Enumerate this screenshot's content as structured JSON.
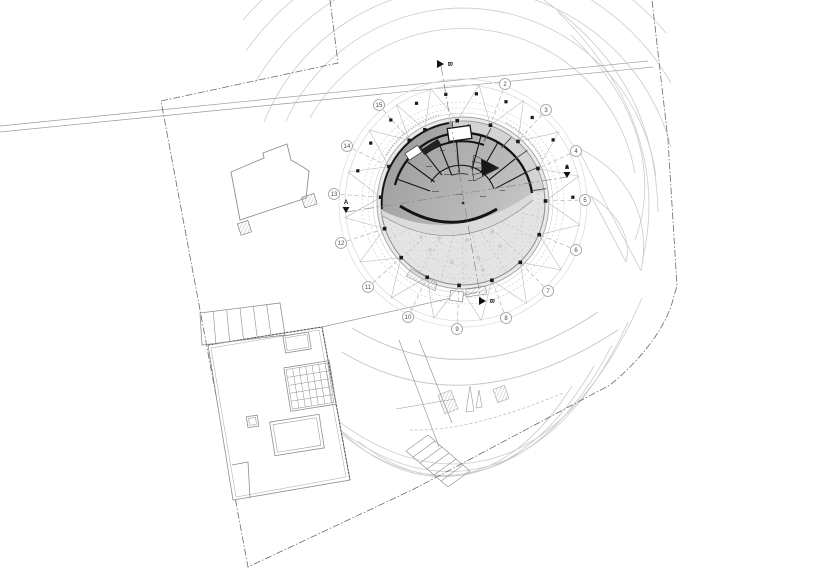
{
  "canvas": {
    "width": 818,
    "height": 578,
    "background": "#ffffff"
  },
  "palette": {
    "landscape": "#cbcbcb",
    "site_line": "#8f8f8f",
    "boundary": "#6a6a6a",
    "grid_dash": "#b0b0b0",
    "truss": "#b5b5b5",
    "bubble_stroke": "#9a9a9a",
    "bubble_fill": "#ffffff",
    "bubble_text": "#4a4a4a",
    "wall": "#141414",
    "disc_fill": "#e7e7e7",
    "floor_dark": "#9d9d9d",
    "floor_light": "#c9c9c9",
    "column": "#1a1a1a",
    "marker": "#111111"
  },
  "building_center": {
    "x": 463,
    "y": 203
  },
  "grid": {
    "bubbles": [
      {
        "label": "2",
        "x": 505,
        "y": 84
      },
      {
        "label": "3",
        "x": 546,
        "y": 110
      },
      {
        "label": "4",
        "x": 576,
        "y": 151
      },
      {
        "label": "5",
        "x": 585,
        "y": 200
      },
      {
        "label": "6",
        "x": 576,
        "y": 250
      },
      {
        "label": "7",
        "x": 548,
        "y": 291
      },
      {
        "label": "8",
        "x": 506,
        "y": 318
      },
      {
        "label": "9",
        "x": 457,
        "y": 329
      },
      {
        "label": "10",
        "x": 408,
        "y": 317
      },
      {
        "label": "11",
        "x": 368,
        "y": 287
      },
      {
        "label": "12",
        "x": 341,
        "y": 243
      },
      {
        "label": "13",
        "x": 334,
        "y": 194
      },
      {
        "label": "14",
        "x": 347,
        "y": 146
      },
      {
        "label": "15",
        "x": 379,
        "y": 105
      }
    ]
  },
  "section_markers": [
    {
      "label": "B",
      "x": 441,
      "y": 64,
      "dir": "right"
    },
    {
      "label": "B",
      "x": 483,
      "y": 301,
      "dir": "right"
    },
    {
      "label": "A",
      "x": 346,
      "y": 207,
      "dir": "down"
    },
    {
      "label": "A",
      "x": 567,
      "y": 172,
      "dir": "down"
    }
  ]
}
